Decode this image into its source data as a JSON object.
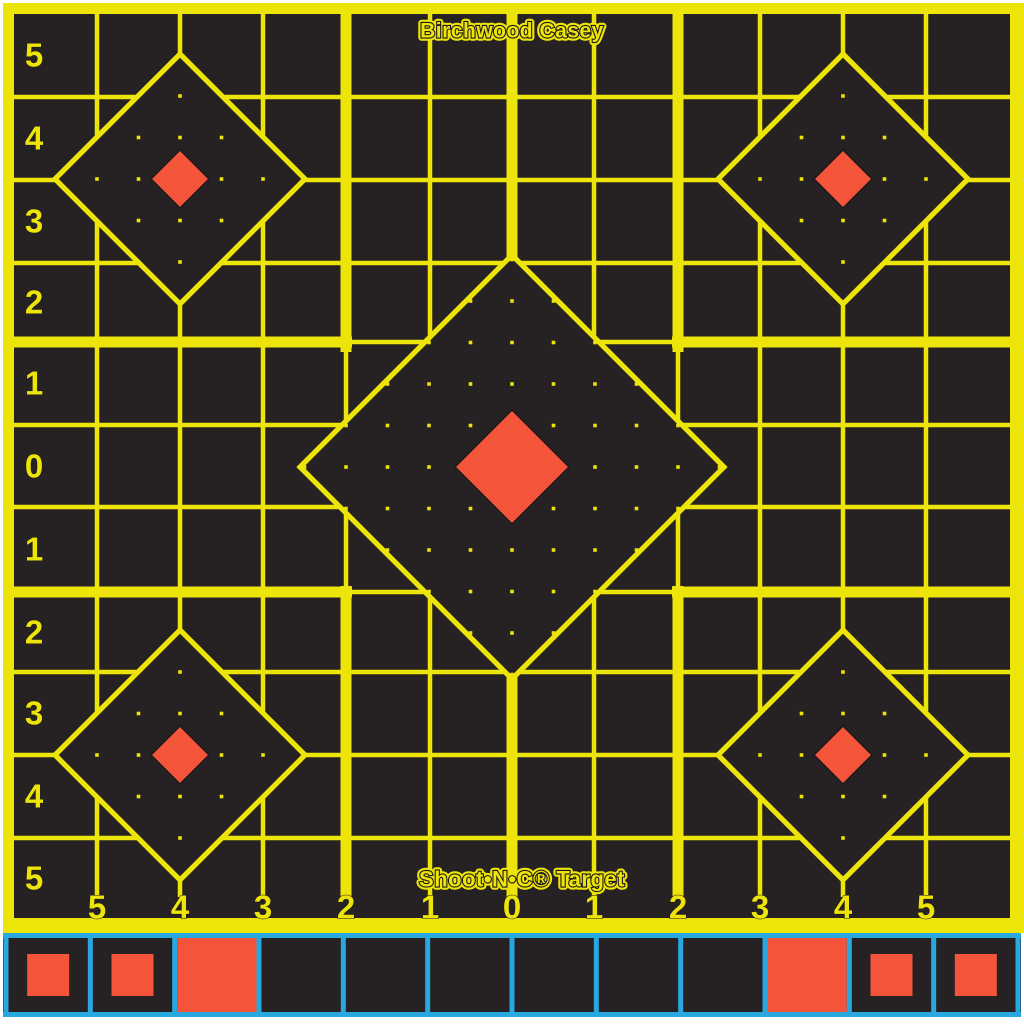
{
  "title": "Shoot-N-C sight-in target sheet",
  "brand": "Birchwood Casey",
  "product": "Shoot•N•C® Target",
  "axes": {
    "left": [
      "5",
      "4",
      "3",
      "2",
      "1",
      "0",
      "1",
      "2",
      "3",
      "4",
      "5"
    ],
    "bottom": [
      "5",
      "4",
      "3",
      "2",
      "1",
      "0",
      "1",
      "2",
      "3",
      "4",
      "5"
    ]
  },
  "colors": {
    "sheet_black": "#262122",
    "grid_yellow": "#EDE409",
    "bullseye_orange": "#F4543A",
    "paster_blue": "#29A8E0",
    "edge_white": "#FFFFFF",
    "dark_outline": "#1D191A"
  },
  "diamonds": [
    {
      "id": "center",
      "size": "large"
    },
    {
      "id": "top-left",
      "size": "small"
    },
    {
      "id": "top-right",
      "size": "small"
    },
    {
      "id": "bottom-left",
      "size": "small"
    },
    {
      "id": "bottom-right",
      "size": "small"
    }
  ],
  "paster_strip": {
    "cells": [
      "paster",
      "paster",
      "filled",
      "empty",
      "empty",
      "empty",
      "empty",
      "empty",
      "empty",
      "filled",
      "paster",
      "paster"
    ]
  }
}
